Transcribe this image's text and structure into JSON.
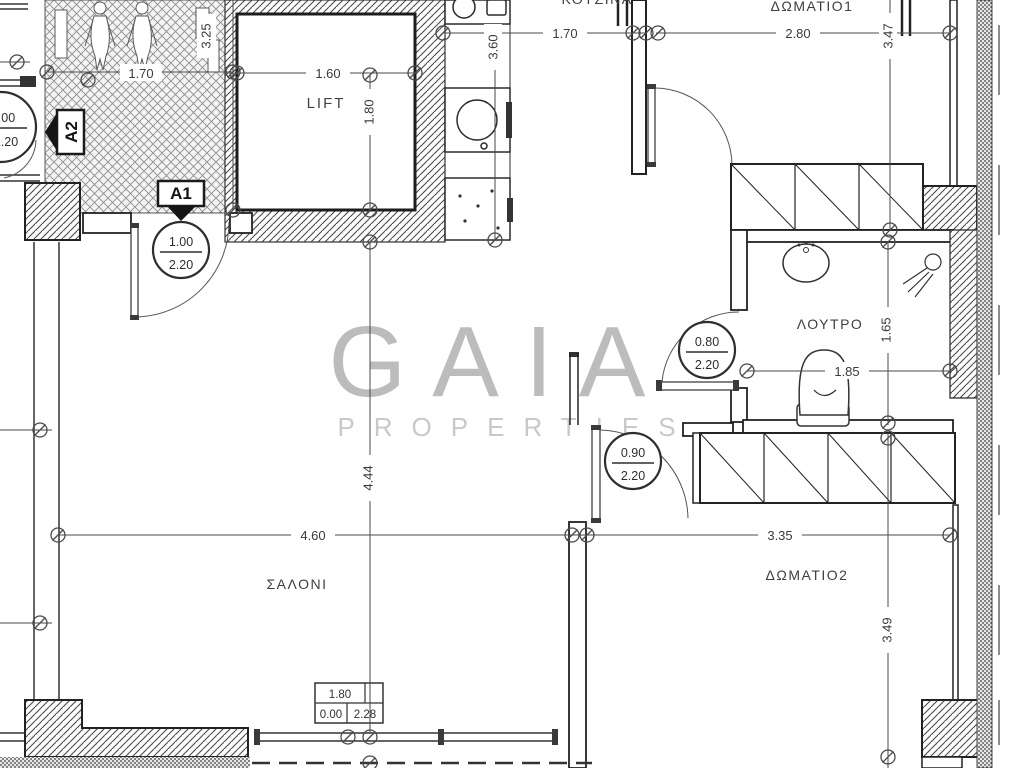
{
  "watermark": {
    "name": "GAIA",
    "tagline": "PROPERTIES"
  },
  "rooms": {
    "lift": "LIFT",
    "kitchen": "ΚΟΥΖΙΝΑ",
    "bedroom1": "ΔΩΜΑΤΙΟ1",
    "bathroom": "ΛΟΥΤΡΟ",
    "living": "ΣΑΛΟΝΙ",
    "bedroom2": "ΔΩΜΑΤΙΟ2"
  },
  "markers": {
    "a1": "A1",
    "a2": "A2"
  },
  "dims": {
    "hall_width": "1.70",
    "hall_depth": "3.25",
    "lift_width": "1.60",
    "lift_depth": "1.80",
    "kitchen_width": "1.70",
    "kitchen_depth": "3.60",
    "bedroom1_width": "2.80",
    "bedroom1_depth": "3.47",
    "bathroom_width": "1.85",
    "bathroom_depth": "1.65",
    "living_width": "4.60",
    "living_depth": "4.44",
    "bedroom2_width": "3.35",
    "bedroom2_depth": "3.49"
  },
  "doors": {
    "stairwell": {
      "width": "1.00",
      "height": "2.20"
    },
    "entrance": {
      "width": "1.00",
      "height": "2.20"
    },
    "bathroom": {
      "width": "0.80",
      "height": "2.20"
    },
    "bedroom2": {
      "width": "0.90",
      "height": "2.20"
    }
  },
  "window_table": {
    "width": "1.80",
    "sill": "0.00",
    "lintel": "2.28"
  },
  "colors": {
    "line": "#3a3a3a",
    "wall": "#1f1f1f",
    "watermark": "#bcbcbc",
    "watermark_sub": "#c9c9c9"
  }
}
